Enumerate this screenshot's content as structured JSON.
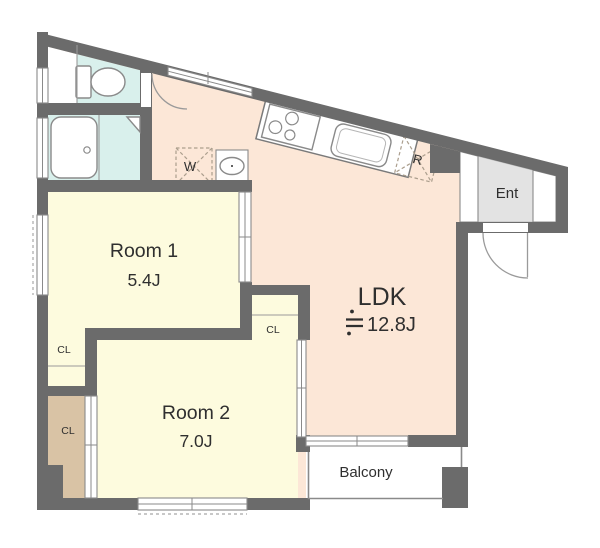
{
  "rooms": {
    "ldk": {
      "name": "LDK",
      "size": "≒12.8J",
      "size_number": "12.8J"
    },
    "room1": {
      "name": "Room 1",
      "size": "5.4J"
    },
    "room2": {
      "name": "Room 2",
      "size": "7.0J"
    },
    "entrance": {
      "label": "Ent"
    },
    "balcony": {
      "label": "Balcony"
    }
  },
  "labels": {
    "closet_room1": "CL",
    "closet_nook": "CL",
    "closet_room2": "CL",
    "washer": "W",
    "refrigerator": "R"
  },
  "colors": {
    "wall": "#6b6b6b",
    "ldk_floor": "#fce7d7",
    "room_floor": "#fdfbde",
    "wet_area_floor": "#d9f0ec",
    "closet_floor": "#d9c3a5",
    "entrance_floor": "#e3e3e3",
    "balcony_floor": "#ffffff",
    "text": "#2f2f2f"
  }
}
